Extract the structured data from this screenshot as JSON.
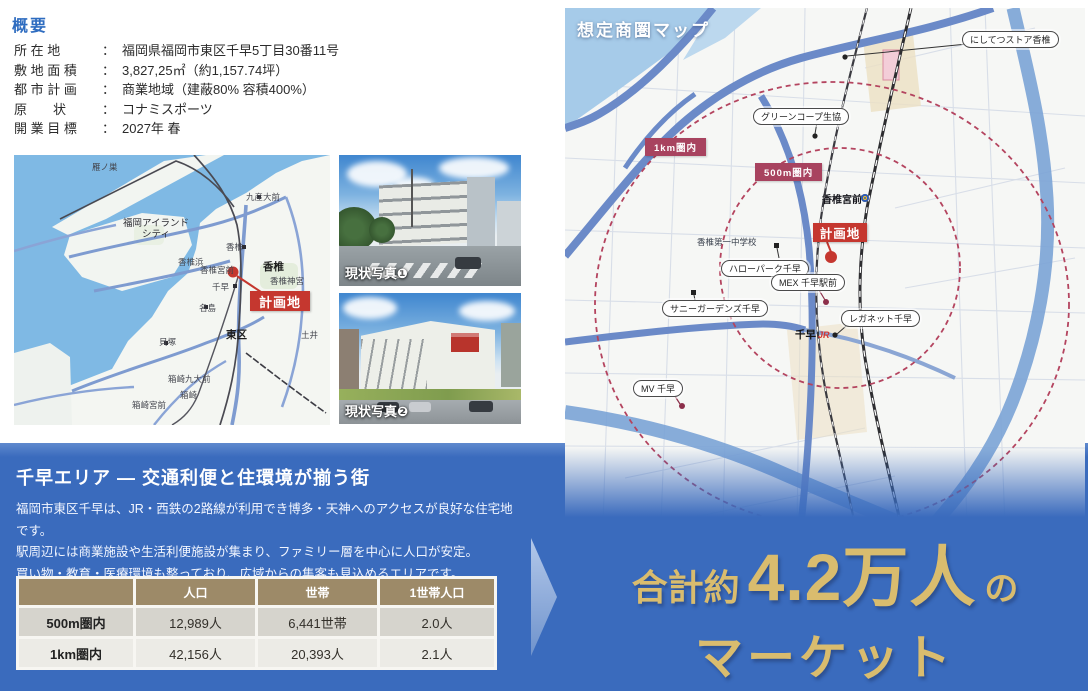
{
  "overview": {
    "heading": "概要",
    "colon": "：",
    "rows": [
      {
        "label": "所 在 地",
        "value": "福岡県福岡市東区千早5丁目30番11号"
      },
      {
        "label": "敷 地 面 積",
        "value": "3,827,25㎡（約1,157.74坪）"
      },
      {
        "label": "都 市 計 画",
        "value": "商業地域（建蔽80% 容積400%）"
      },
      {
        "label": "原　　状",
        "value": "コナミスポーツ"
      },
      {
        "label": "開 業 目 標",
        "value": "2027年 春"
      }
    ]
  },
  "access_map": {
    "plan_site": "計画地",
    "labels": [
      {
        "text": "雁ノ巣",
        "x": 78,
        "y": 8,
        "cls": "xs"
      },
      {
        "text": "九産大前",
        "x": 232,
        "y": 38,
        "cls": "xs"
      },
      {
        "text": "福岡アイランド\nシティ",
        "x": 96,
        "y": 64,
        "cls": "two-line"
      },
      {
        "text": "香椎",
        "x": 212,
        "y": 88,
        "cls": "xs"
      },
      {
        "text": "香椎浜",
        "x": 164,
        "y": 103,
        "cls": "xs"
      },
      {
        "text": "香椎宮前",
        "x": 186,
        "y": 111,
        "cls": "xs"
      },
      {
        "text": "香椎",
        "x": 249,
        "y": 106,
        "cls": "bold"
      },
      {
        "text": "香椎神宮",
        "x": 256,
        "y": 122,
        "cls": "xs"
      },
      {
        "text": "千早",
        "x": 198,
        "y": 128,
        "cls": "xs"
      },
      {
        "text": "名島",
        "x": 185,
        "y": 149,
        "cls": "xs"
      },
      {
        "text": "東区",
        "x": 212,
        "y": 174,
        "cls": "bold"
      },
      {
        "text": "土井",
        "x": 287,
        "y": 176,
        "cls": "xs"
      },
      {
        "text": "貝塚",
        "x": 145,
        "y": 183,
        "cls": "xs"
      },
      {
        "text": "箱崎九大前",
        "x": 154,
        "y": 220,
        "cls": "xs"
      },
      {
        "text": "箱崎",
        "x": 166,
        "y": 236,
        "cls": "xs"
      },
      {
        "text": "箱崎宮前",
        "x": 118,
        "y": 246,
        "cls": "xs"
      }
    ]
  },
  "photos": [
    {
      "caption": "現状写真❶"
    },
    {
      "caption": "現状写真❷"
    }
  ],
  "trade_map": {
    "title": "想定商圏マップ",
    "plan_site": "計画地",
    "station": {
      "name": "千早",
      "logo": "JR"
    },
    "labels": [
      {
        "text": "にしてつストア香椎",
        "x": 397,
        "y": 23,
        "cls": "pill"
      },
      {
        "text": "グリーンコープ生協",
        "x": 188,
        "y": 100,
        "cls": "pill"
      },
      {
        "text": "1km圏内",
        "x": 80,
        "y": 130,
        "cls": "badge"
      },
      {
        "text": "500m圏内",
        "x": 190,
        "y": 155,
        "cls": "badge"
      },
      {
        "text": "香椎宮前",
        "x": 257,
        "y": 183,
        "cls": "place"
      },
      {
        "text": "香椎第一中学校",
        "x": 132,
        "y": 228,
        "cls": "place small"
      },
      {
        "text": "ハローパーク千早",
        "x": 156,
        "y": 252,
        "cls": "pill"
      },
      {
        "text": "MEX 千早駅前",
        "x": 206,
        "y": 266,
        "cls": "pill"
      },
      {
        "text": "サニーガーデンズ千早",
        "x": 97,
        "y": 292,
        "cls": "pill"
      },
      {
        "text": "レガネット千早",
        "x": 276,
        "y": 302,
        "cls": "pill"
      },
      {
        "text": "MV 千早",
        "x": 68,
        "y": 372,
        "cls": "pill"
      }
    ]
  },
  "area_section": {
    "title": "千早エリア ― 交通利便と住環境が揃う街",
    "body": [
      "福岡市東区千早は、JR・西鉄の2路線が利用でき博多・天神へのアクセスが良好な住宅地です。",
      "駅周辺には商業施設や生活利便施設が集まり、ファミリー層を中心に人口が安定。",
      "買い物・教育・医療環境も整っており、広域からの集客も見込めるエリアです。"
    ],
    "table": {
      "headers": [
        "",
        "人口",
        "世帯",
        "1世帯人口"
      ],
      "rows": [
        {
          "label": "500m圏内",
          "population": "12,989人",
          "households": "6,441世帯",
          "per_household": "2.0人"
        },
        {
          "label": "1km圏内",
          "population": "42,156人",
          "households": "20,393人",
          "per_household": "2.1人"
        }
      ]
    }
  },
  "market_callout": {
    "prefix": "合計約",
    "big": "4.2万人",
    "particle": "の",
    "line2": "マーケット"
  },
  "colors": {
    "band_blue": "#3a6bbd",
    "accent_gold": "#d9bc6e",
    "heading_blue": "#2e6cc0",
    "plan_site_red": "#c5372f",
    "radius_badge_maroon": "#a8435f",
    "table_header_tan": "#9d8a68"
  }
}
